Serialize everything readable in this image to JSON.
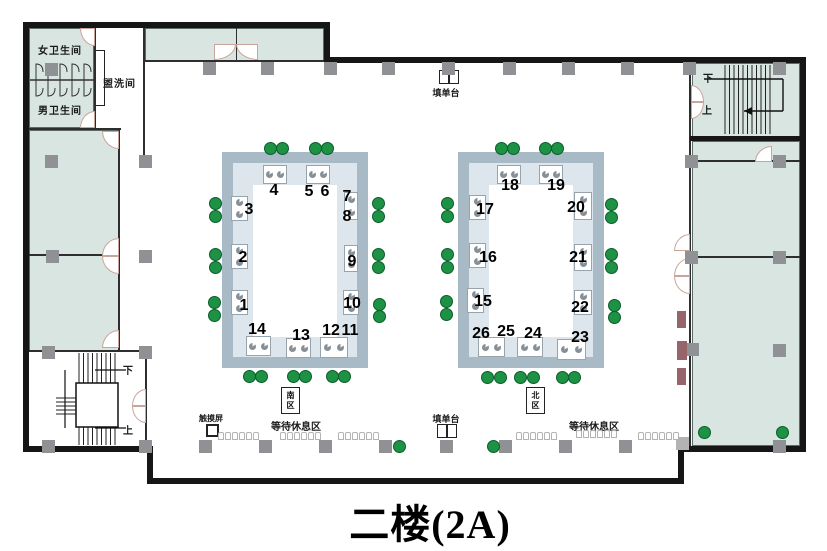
{
  "title": "二楼(2A)",
  "labels": {
    "women_restroom": "女卫生间",
    "men_restroom": "男卫生间",
    "washroom": "盥洗间",
    "form_counter_top": "填单台",
    "form_counter_bottom": "填单台",
    "touch_screen": "触摸屏",
    "waiting_area_left": "等待休息区",
    "waiting_area_right": "等待休息区",
    "stairs_tr_down": "下",
    "stairs_tr_up": "上",
    "stairs_bl_down": "下",
    "stairs_bl_up": "上",
    "zone_south_line1": "南",
    "zone_south_line2": "区",
    "zone_north_line1": "北",
    "zone_north_line2": "区"
  },
  "colors": {
    "wall": "#161616",
    "room_fill": "#d8e5e0",
    "ring_band": "#a9bac7",
    "ring_inner": "#dde6ec",
    "column_gray": "#8f9194",
    "green_dot": "#1d9144",
    "maroon_block": "#96646a"
  },
  "windows": [
    {
      "n": "1",
      "x": 244,
      "y": 306
    },
    {
      "n": "2",
      "x": 243,
      "y": 258
    },
    {
      "n": "3",
      "x": 249,
      "y": 210
    },
    {
      "n": "4",
      "x": 274,
      "y": 191
    },
    {
      "n": "5",
      "x": 309,
      "y": 192
    },
    {
      "n": "6",
      "x": 325,
      "y": 192
    },
    {
      "n": "7",
      "x": 347,
      "y": 197
    },
    {
      "n": "8",
      "x": 347,
      "y": 217
    },
    {
      "n": "9",
      "x": 352,
      "y": 262
    },
    {
      "n": "10",
      "x": 352,
      "y": 304
    },
    {
      "n": "11",
      "x": 350,
      "y": 331
    },
    {
      "n": "12",
      "x": 331,
      "y": 331
    },
    {
      "n": "13",
      "x": 301,
      "y": 336
    },
    {
      "n": "14",
      "x": 257,
      "y": 330
    },
    {
      "n": "15",
      "x": 483,
      "y": 302
    },
    {
      "n": "16",
      "x": 488,
      "y": 258
    },
    {
      "n": "17",
      "x": 485,
      "y": 210
    },
    {
      "n": "18",
      "x": 510,
      "y": 186
    },
    {
      "n": "19",
      "x": 556,
      "y": 186
    },
    {
      "n": "20",
      "x": 576,
      "y": 208
    },
    {
      "n": "21",
      "x": 578,
      "y": 258
    },
    {
      "n": "22",
      "x": 580,
      "y": 308
    },
    {
      "n": "23",
      "x": 580,
      "y": 338
    },
    {
      "n": "24",
      "x": 533,
      "y": 334
    },
    {
      "n": "25",
      "x": 506,
      "y": 332
    },
    {
      "n": "26",
      "x": 481,
      "y": 334
    }
  ],
  "geometry": {
    "walls": [
      {
        "x": 23,
        "y": 22,
        "w": 307,
        "h": 6
      },
      {
        "x": 324,
        "y": 22,
        "w": 6,
        "h": 41
      },
      {
        "x": 324,
        "y": 57,
        "w": 482,
        "h": 6
      },
      {
        "x": 800,
        "y": 57,
        "w": 6,
        "h": 395
      },
      {
        "x": 678,
        "y": 446,
        "w": 128,
        "h": 6
      },
      {
        "x": 678,
        "y": 446,
        "w": 6,
        "h": 38
      },
      {
        "x": 147,
        "y": 478,
        "w": 537,
        "h": 6
      },
      {
        "x": 147,
        "y": 446,
        "w": 6,
        "h": 38
      },
      {
        "x": 23,
        "y": 446,
        "w": 130,
        "h": 6
      },
      {
        "x": 23,
        "y": 22,
        "w": 6,
        "h": 430
      },
      {
        "x": 690,
        "y": 136,
        "w": 116,
        "h": 5
      }
    ],
    "thin_walls": [
      {
        "x": 94,
        "y": 28,
        "w": 2,
        "h": 102
      },
      {
        "x": 29,
        "y": 128,
        "w": 92,
        "h": 2
      },
      {
        "x": 143,
        "y": 28,
        "w": 2,
        "h": 134
      },
      {
        "x": 143,
        "y": 60,
        "w": 183,
        "h": 2
      },
      {
        "x": 236,
        "y": 28,
        "w": 1,
        "h": 33
      },
      {
        "x": 118,
        "y": 130,
        "w": 2,
        "h": 222
      },
      {
        "x": 29,
        "y": 254,
        "w": 91,
        "h": 2
      },
      {
        "x": 29,
        "y": 350,
        "w": 118,
        "h": 2
      },
      {
        "x": 145,
        "y": 352,
        "w": 2,
        "h": 94
      },
      {
        "x": 689,
        "y": 63,
        "w": 2,
        "h": 383
      },
      {
        "x": 690,
        "y": 160,
        "w": 110,
        "h": 2
      },
      {
        "x": 690,
        "y": 256,
        "w": 110,
        "h": 2
      }
    ],
    "rooms": [
      {
        "x": 29,
        "y": 28,
        "w": 65,
        "h": 100
      },
      {
        "x": 145,
        "y": 28,
        "w": 179,
        "h": 33
      },
      {
        "x": 29,
        "y": 130,
        "w": 90,
        "h": 221
      },
      {
        "x": 692,
        "y": 63,
        "w": 108,
        "h": 74
      },
      {
        "x": 692,
        "y": 141,
        "w": 108,
        "h": 305
      }
    ],
    "columns": [
      [
        45,
        63
      ],
      [
        203,
        62
      ],
      [
        261,
        62
      ],
      [
        324,
        62
      ],
      [
        382,
        62
      ],
      [
        442,
        62
      ],
      [
        503,
        62
      ],
      [
        562,
        62
      ],
      [
        621,
        62
      ],
      [
        683,
        62
      ],
      [
        773,
        62
      ],
      [
        45,
        155
      ],
      [
        139,
        155
      ],
      [
        685,
        155
      ],
      [
        773,
        155
      ],
      [
        46,
        250
      ],
      [
        139,
        250
      ],
      [
        685,
        251
      ],
      [
        773,
        251
      ],
      [
        42,
        346
      ],
      [
        139,
        346
      ],
      [
        686,
        343
      ],
      [
        773,
        344
      ],
      [
        42,
        440
      ],
      [
        139,
        440
      ],
      [
        199,
        440
      ],
      [
        259,
        440
      ],
      [
        319,
        440
      ],
      [
        379,
        440
      ],
      [
        440,
        440
      ],
      [
        499,
        440
      ],
      [
        559,
        440
      ],
      [
        619,
        440
      ],
      [
        773,
        440
      ]
    ],
    "columns_light": [
      [
        676,
        437
      ]
    ],
    "dots": [
      [
        270,
        148
      ],
      [
        282,
        148
      ],
      [
        315,
        148
      ],
      [
        327,
        148
      ],
      [
        215,
        203
      ],
      [
        215,
        216
      ],
      [
        215,
        254
      ],
      [
        215,
        267
      ],
      [
        214,
        302
      ],
      [
        214,
        315
      ],
      [
        378,
        203
      ],
      [
        378,
        216
      ],
      [
        378,
        254
      ],
      [
        378,
        267
      ],
      [
        379,
        304
      ],
      [
        379,
        316
      ],
      [
        249,
        376
      ],
      [
        261,
        376
      ],
      [
        293,
        376
      ],
      [
        305,
        376
      ],
      [
        332,
        376
      ],
      [
        344,
        376
      ],
      [
        501,
        148
      ],
      [
        513,
        148
      ],
      [
        545,
        148
      ],
      [
        557,
        148
      ],
      [
        447,
        203
      ],
      [
        447,
        216
      ],
      [
        447,
        254
      ],
      [
        447,
        267
      ],
      [
        446,
        301
      ],
      [
        446,
        314
      ],
      [
        611,
        204
      ],
      [
        611,
        217
      ],
      [
        611,
        254
      ],
      [
        611,
        267
      ],
      [
        614,
        305
      ],
      [
        614,
        317
      ],
      [
        487,
        377
      ],
      [
        500,
        377
      ],
      [
        520,
        377
      ],
      [
        533,
        377
      ],
      [
        562,
        377
      ],
      [
        574,
        377
      ],
      [
        399,
        446
      ],
      [
        493,
        446
      ],
      [
        704,
        432
      ],
      [
        782,
        432
      ]
    ],
    "desks": [
      {
        "x": 263,
        "y": 165,
        "w": 24,
        "h": 19,
        "o": "h"
      },
      {
        "x": 306,
        "y": 165,
        "w": 24,
        "h": 19,
        "o": "h"
      },
      {
        "x": 231,
        "y": 196,
        "w": 17,
        "h": 25,
        "o": "v"
      },
      {
        "x": 231,
        "y": 244,
        "w": 17,
        "h": 25,
        "o": "v"
      },
      {
        "x": 231,
        "y": 290,
        "w": 17,
        "h": 25,
        "o": "v"
      },
      {
        "x": 344,
        "y": 192,
        "w": 14,
        "h": 28,
        "o": "v"
      },
      {
        "x": 344,
        "y": 245,
        "w": 14,
        "h": 27,
        "o": "v"
      },
      {
        "x": 343,
        "y": 290,
        "w": 16,
        "h": 25,
        "o": "v"
      },
      {
        "x": 246,
        "y": 336,
        "w": 25,
        "h": 20,
        "o": "h"
      },
      {
        "x": 286,
        "y": 338,
        "w": 25,
        "h": 20,
        "o": "h"
      },
      {
        "x": 320,
        "y": 337,
        "w": 28,
        "h": 21,
        "o": "h"
      },
      {
        "x": 497,
        "y": 165,
        "w": 24,
        "h": 19,
        "o": "h"
      },
      {
        "x": 539,
        "y": 165,
        "w": 24,
        "h": 19,
        "o": "h"
      },
      {
        "x": 469,
        "y": 195,
        "w": 17,
        "h": 25,
        "o": "v"
      },
      {
        "x": 469,
        "y": 243,
        "w": 17,
        "h": 25,
        "o": "v"
      },
      {
        "x": 467,
        "y": 288,
        "w": 17,
        "h": 25,
        "o": "v"
      },
      {
        "x": 574,
        "y": 192,
        "w": 18,
        "h": 28,
        "o": "v"
      },
      {
        "x": 574,
        "y": 244,
        "w": 18,
        "h": 27,
        "o": "v"
      },
      {
        "x": 574,
        "y": 290,
        "w": 18,
        "h": 25,
        "o": "v"
      },
      {
        "x": 478,
        "y": 337,
        "w": 27,
        "h": 20,
        "o": "h"
      },
      {
        "x": 517,
        "y": 337,
        "w": 26,
        "h": 20,
        "o": "h"
      },
      {
        "x": 557,
        "y": 339,
        "w": 29,
        "h": 21,
        "o": "h"
      }
    ],
    "doors": [
      {
        "x": 80,
        "y": 28,
        "w": 15,
        "h": 18,
        "c": "bl"
      },
      {
        "x": 80,
        "y": 111,
        "w": 15,
        "h": 17,
        "c": "tl"
      },
      {
        "x": 214,
        "y": 44,
        "w": 22,
        "h": 16,
        "c": "br"
      },
      {
        "x": 236,
        "y": 44,
        "w": 22,
        "h": 16,
        "c": "bl"
      },
      {
        "x": 102,
        "y": 131,
        "w": 17,
        "h": 18,
        "c": "bl"
      },
      {
        "x": 102,
        "y": 238,
        "w": 17,
        "h": 18,
        "c": "tl"
      },
      {
        "x": 102,
        "y": 256,
        "w": 17,
        "h": 18,
        "c": "bl"
      },
      {
        "x": 102,
        "y": 330,
        "w": 17,
        "h": 18,
        "c": "tl"
      },
      {
        "x": 674,
        "y": 234,
        "w": 16,
        "h": 17,
        "c": "tl"
      },
      {
        "x": 674,
        "y": 258,
        "w": 16,
        "h": 18,
        "c": "tl"
      },
      {
        "x": 674,
        "y": 276,
        "w": 16,
        "h": 18,
        "c": "bl"
      },
      {
        "x": 755,
        "y": 146,
        "w": 17,
        "h": 16,
        "c": "tl"
      },
      {
        "x": 691,
        "y": 85,
        "w": 13,
        "h": 17,
        "c": "tr"
      },
      {
        "x": 691,
        "y": 102,
        "w": 13,
        "h": 17,
        "c": "br"
      },
      {
        "x": 132,
        "y": 389,
        "w": 14,
        "h": 17,
        "c": "tl"
      },
      {
        "x": 132,
        "y": 406,
        "w": 14,
        "h": 17,
        "c": "bl"
      }
    ],
    "chair_rows": [
      [
        218,
        432
      ],
      [
        280,
        432
      ],
      [
        338,
        432
      ],
      [
        516,
        432
      ],
      [
        576,
        430
      ],
      [
        638,
        432
      ]
    ],
    "maroon_blocks": [
      {
        "x": 677,
        "y": 311,
        "w": 9,
        "h": 17
      },
      {
        "x": 677,
        "y": 341,
        "w": 10,
        "h": 19
      },
      {
        "x": 677,
        "y": 368,
        "w": 9,
        "h": 17
      }
    ]
  }
}
